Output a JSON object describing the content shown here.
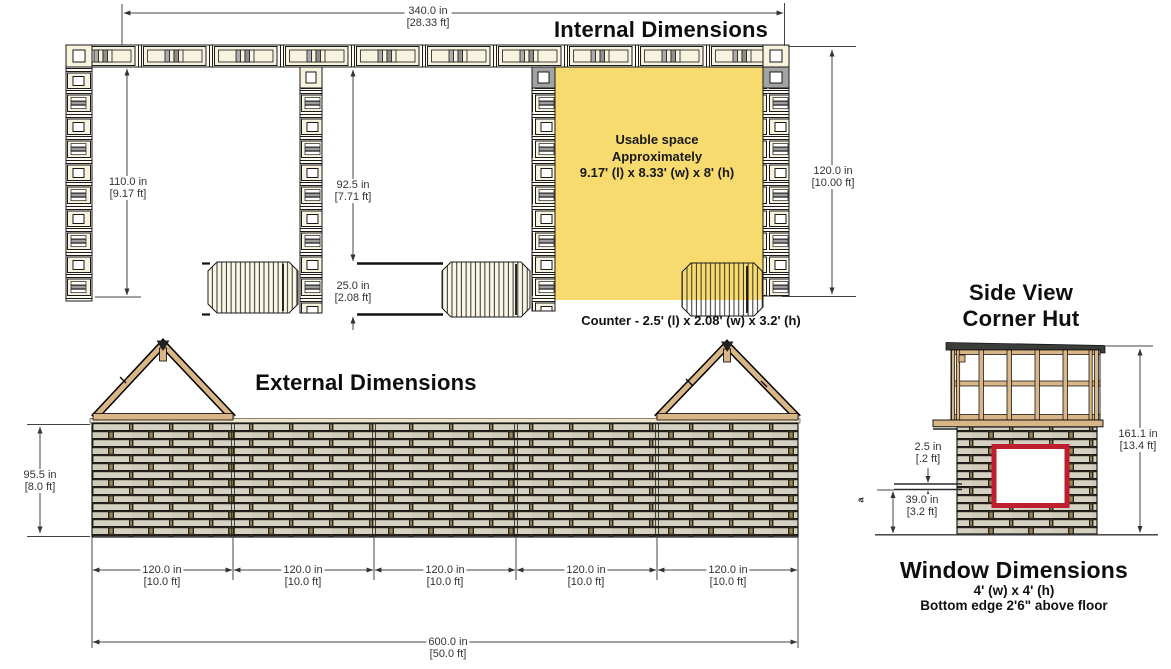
{
  "internal": {
    "title": "Internal Dimensions",
    "dim_340": {
      "in": "340.0 in",
      "ft": "[28.33 ft]"
    },
    "dim_110": {
      "in": "110.0 in",
      "ft": "[9.17 ft]"
    },
    "dim_92": {
      "in": "92.5 in",
      "ft": "[7.71 ft]"
    },
    "dim_25": {
      "in": "25.0 in",
      "ft": "[2.08 ft]"
    },
    "dim_120": {
      "in": "120.0 in",
      "ft": "[10.00 ft]"
    },
    "usable_space": {
      "line1": "Usable space",
      "line2": "Approximately",
      "line3": "9.17' (l)  x 8.33' (w) x 8' (h)"
    },
    "counter_label": "Counter - 2.5' (l) x 2.08' (w) x 3.2' (h)"
  },
  "external": {
    "title": "External Dimensions",
    "dim_95": {
      "in": "95.5 in",
      "ft": "[8.0 ft]"
    },
    "bay_dims": [
      {
        "in": "120.0 in",
        "ft": "[10.0 ft]"
      },
      {
        "in": "120.0 in",
        "ft": "[10.0 ft]"
      },
      {
        "in": "120.0 in",
        "ft": "[10.0 ft]"
      },
      {
        "in": "120.0 in",
        "ft": "[10.0 ft]"
      },
      {
        "in": "120.0 in",
        "ft": "[10.0 ft]"
      }
    ],
    "dim_600": {
      "in": "600.0 in",
      "ft": "[50.0 ft]"
    }
  },
  "side_view": {
    "title_line1": "Side View",
    "title_line2": "Corner Hut",
    "dim_161": {
      "in": "161.1 in",
      "ft": "[13.4 ft]"
    },
    "dim_2_5": {
      "in": "2.5 in",
      "ft": "[.2 ft]"
    },
    "dim_39": {
      "in": "39.0 in",
      "ft": "[3.2 ft]"
    },
    "marker": "a",
    "window": {
      "title": "Window Dimensions",
      "size": "4' (w) x 4' (h)",
      "note": "Bottom edge 2'6\" above floor"
    }
  },
  "colors": {
    "highlight_yellow": "#F8DB6E",
    "window_red": "#BE1E2D",
    "timber_tan": "#D9B687",
    "roof_dark": "#3C3C3A",
    "brick_slat": "#D4D0C2",
    "brick_joint": "#39342A"
  }
}
